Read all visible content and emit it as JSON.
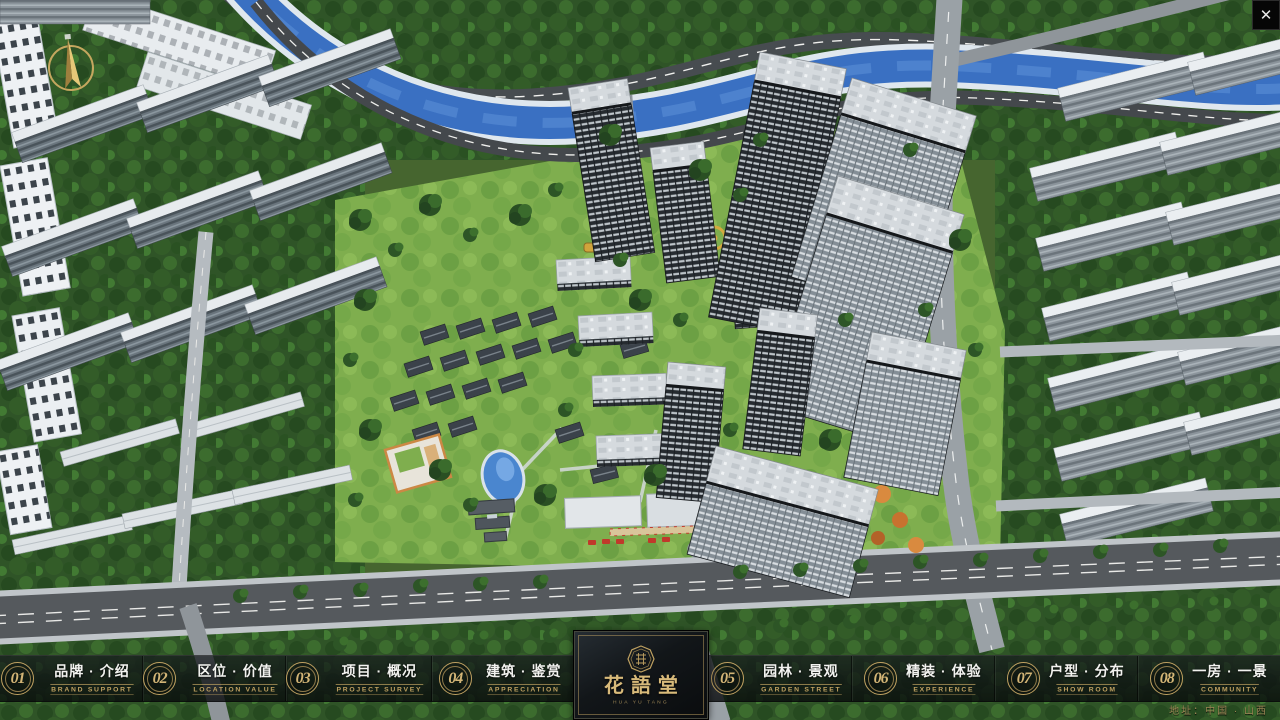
{
  "colors": {
    "gold": "#bfa161",
    "gold-dim": "#8f7a4a",
    "text": "#f2f2ef",
    "bar-bg": "rgba(12,15,17,0.62)",
    "river-blue": "#3a70c2",
    "tree-green": "#2f5427"
  },
  "icons": {
    "close_glyph": "✕",
    "compass": "compass-north-arrow",
    "logo_seal": "octagon-seal"
  },
  "nav": {
    "items": [
      {
        "num": "01",
        "label": "品牌 · 介绍",
        "sub": "BRAND SUPPORT"
      },
      {
        "num": "02",
        "label": "区位 · 价值",
        "sub": "LOCATION VALUE"
      },
      {
        "num": "03",
        "label": "项目 · 概况",
        "sub": "PROJECT SURVEY"
      },
      {
        "num": "04",
        "label": "建筑 · 鉴赏",
        "sub": "APPRECIATION"
      },
      {
        "num": "05",
        "label": "园林 · 景观",
        "sub": "GARDEN STREET"
      },
      {
        "num": "06",
        "label": "精装 · 体验",
        "sub": "EXPERIENCE"
      },
      {
        "num": "07",
        "label": "户型 · 分布",
        "sub": "SHOW ROOM"
      },
      {
        "num": "08",
        "label": "一房 · 一景",
        "sub": "COMMUNITY"
      }
    ]
  },
  "logo": {
    "title": "花語堂",
    "subtitle": "HUA YU TANG"
  },
  "footer": {
    "address": "地址：中国 · 山西"
  }
}
